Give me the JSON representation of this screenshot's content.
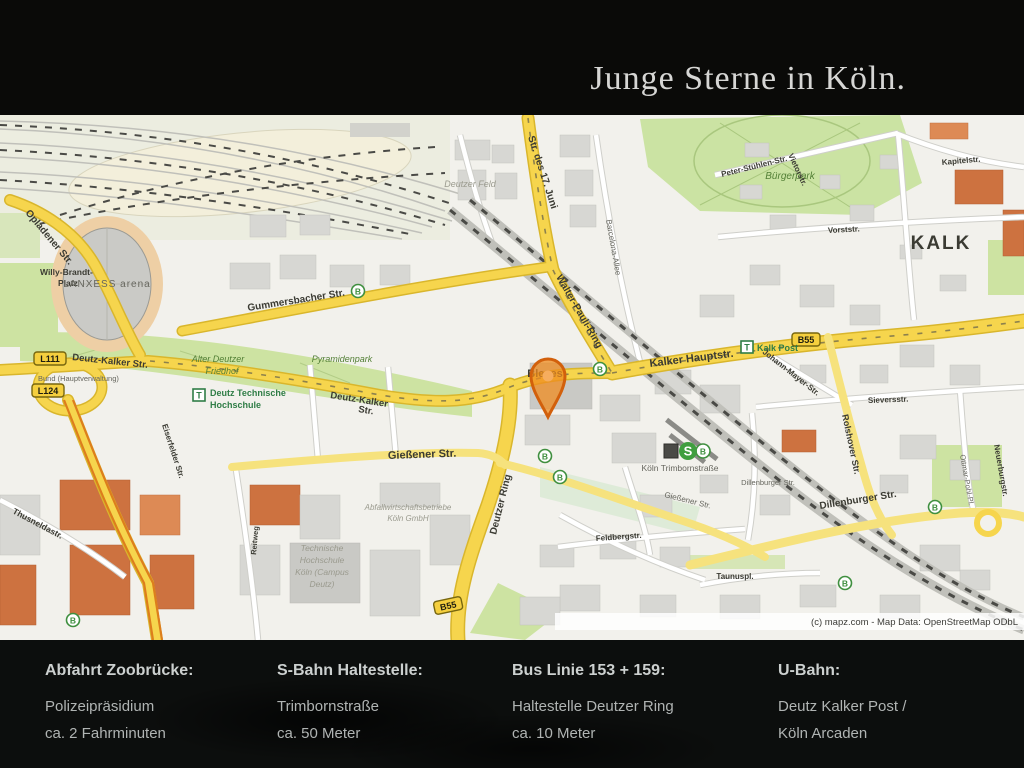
{
  "header": {
    "title": "Junge Sterne in Köln."
  },
  "map": {
    "attribution": "(c) mapz.com - Map Data: OpenStreetMap ODbL",
    "colors": {
      "road_yellow": "#f6d54d",
      "park_green": "#cde3a2",
      "pin_orange": "#ee7d1e",
      "transit_green": "#2f7d46"
    },
    "badges": {
      "l111": "L111",
      "l124": "L124",
      "b55": "B55",
      "bus": "B",
      "tram": "T",
      "sbahn": "S"
    },
    "labels": {
      "opladener": "Opladener Str.",
      "willy_brandt_1": "Willy-Brandt-",
      "willy_brandt_2": "Platz",
      "lanxess": "LANXESS arena",
      "gummersbacher": "Gummersbacher Str.",
      "deutz_kalker_w": "Deutz-Kalker Str.",
      "deutz_kalker_c1": "Deutz-Kalker",
      "deutz_kalker_c2": "Str.",
      "alter_friedhof_1": "Alter Deutzer",
      "alter_friedhof_2": "Friedhof",
      "pyramidenpark": "Pyramidenpark",
      "deutz_th_1": "Deutz Technische",
      "deutz_th_2": "Hochschule",
      "hauptverwaltung": "Bund (Hauptverwaltung)",
      "thusneldastr": "Thusneldastr.",
      "eiserfelder": "Eiserfelder Str.",
      "reitweg": "Reitweg",
      "th_koeln_1": "Technische",
      "th_koeln_2": "Hochschule",
      "th_koeln_3": "Köln (Campus",
      "th_koeln_4": "Deutz)",
      "abfall_1": "Abfallwirtschaftsbetriebe",
      "abfall_2": "Köln GmbH",
      "giessener": "Gießener Str.",
      "giessener_e": "Gießener Str.",
      "deutzer_ring": "Deutzer Ring",
      "str17juni": "Str. des 17. Juni",
      "walter_pauli": "Walter-Pauli-Ring",
      "barcelona": "Barcelona-Allee",
      "deutzer_feld": "Deutzer Feld",
      "buergerpark": "Bürgerpark",
      "bleses": "Bleses",
      "kalker_hauptstr": "Kalker Hauptstr.",
      "kalk_post": "Kalk Post",
      "kalk": "KALK",
      "kapitelstr": "Kapitelstr.",
      "peter_stuhlen": "Peter-Stühlen-Str.",
      "vietorstr": "Vietorstr.",
      "vorststr": "Vorststr.",
      "sieversstr": "Sieversstr.",
      "johann_mayer": "Johann-Mayer-Str.",
      "rolshover": "Rolshover Str.",
      "dillenburger": "Dillenburger Str.",
      "dillenburger_small": "Dillenburger Str.",
      "neuerburgstr": "Neuerburgstr.",
      "ottmar_pohl": "Ottmar-Pohl-Pl.",
      "trimborn_station": "Köln Trimbornstraße",
      "taunuspl": "Taunuspl.",
      "feldbergstr": "Feldbergstr."
    }
  },
  "footer": {
    "columns": [
      {
        "heading": "Abfahrt Zoobrücke:",
        "line1": "Polizeipräsidium",
        "line2": "ca. 2 Fahrminuten"
      },
      {
        "heading": "S-Bahn Haltestelle:",
        "line1": "Trimbornstraße",
        "line2": "ca. 50 Meter"
      },
      {
        "heading": "Bus Linie 153 + 159:",
        "line1": "Haltestelle Deutzer Ring",
        "line2": "ca. 10 Meter"
      },
      {
        "heading": "U-Bahn:",
        "line1": "Deutz Kalker Post /",
        "line2": "Köln Arcaden"
      }
    ]
  }
}
